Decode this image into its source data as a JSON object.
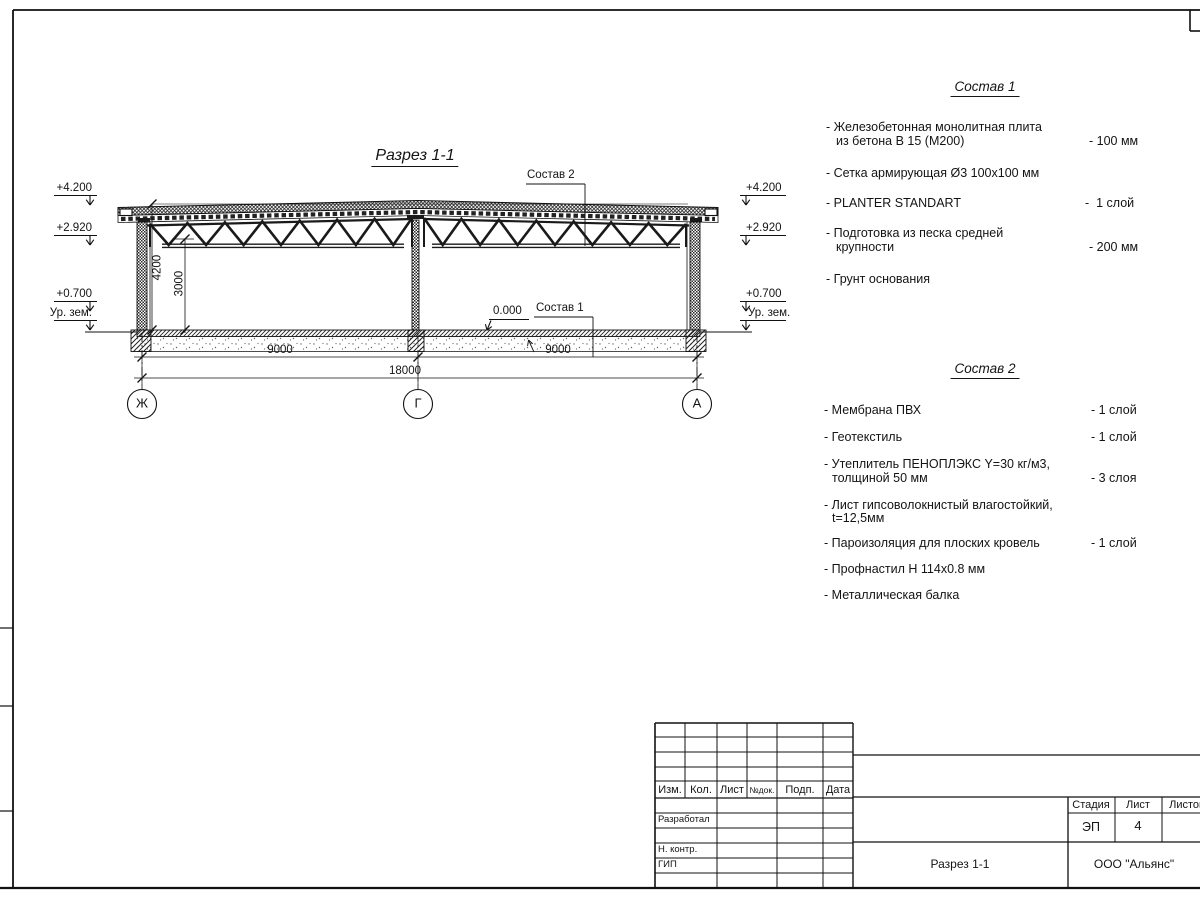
{
  "drawing": {
    "title": "Разрез 1-1",
    "elev_4200": "+4.200",
    "elev_2920": "+2.920",
    "elev_0700": "+0.700",
    "elev_ground": "Ур. зем.",
    "elev_zero": "0.000",
    "dim_4200": "4200",
    "dim_3000": "3000",
    "dim_9000_left": "9000",
    "dim_9000_right": "9000",
    "dim_18000": "18000",
    "axis_left": "Ж",
    "axis_mid": "Г",
    "axis_right": "А",
    "leader_sostav1": "Состав 1",
    "leader_sostav2": "Состав 2"
  },
  "sostav1": {
    "title": "Состав 1",
    "items": [
      {
        "line1": "- Железобетонная  монолитная плита",
        "line2": "из бетона В 15 (М200)",
        "value": "- 100 мм"
      },
      {
        "line1": "- Сетка армирующая Ø3 100х100 мм"
      },
      {
        "line1": "- PLANTER STANDART",
        "value": "-  1 слой"
      },
      {
        "line1": "- Подготовка из песка средней",
        "line2": "крупности",
        "value": "- 200 мм"
      },
      {
        "line1": "- Грунт основания"
      }
    ]
  },
  "sostav2": {
    "title": "Состав 2",
    "items": [
      {
        "line1": "- Мембрана ПВХ",
        "value": "- 1 слой"
      },
      {
        "line1": "- Геотекстиль",
        "value": "- 1 слой"
      },
      {
        "line1": "- Утеплитель ПЕНОПЛЭКС Y=30 кг/м3,",
        "line2": "толщиной 50 мм",
        "value": "- 3 слоя"
      },
      {
        "line1": "- Лист гипсоволокнистый влагостойкий,",
        "line2": "t=12,5мм"
      },
      {
        "line1": "- Пароизоляция для плоских кровель",
        "value": "- 1 слой"
      },
      {
        "line1": "- Профнастил Н 114х0.8 мм"
      },
      {
        "line1": "- Металлическая балка"
      }
    ]
  },
  "titleblock": {
    "col_izm": "Изм.",
    "col_kol": "Кол.",
    "col_list": "Лист",
    "col_ndok": "№док.",
    "col_podp": "Подп.",
    "col_data": "Дата",
    "row_developed": "Разработал",
    "row_ncontr": "Н. контр.",
    "row_gip": "ГИП",
    "stage_label": "Стадия",
    "sheet_label": "Лист",
    "sheets_label": "Листов",
    "stage_value": "ЭП",
    "sheet_value": "4",
    "doc_name": "Разрез 1-1",
    "company": "ООО \"Альянс\""
  }
}
